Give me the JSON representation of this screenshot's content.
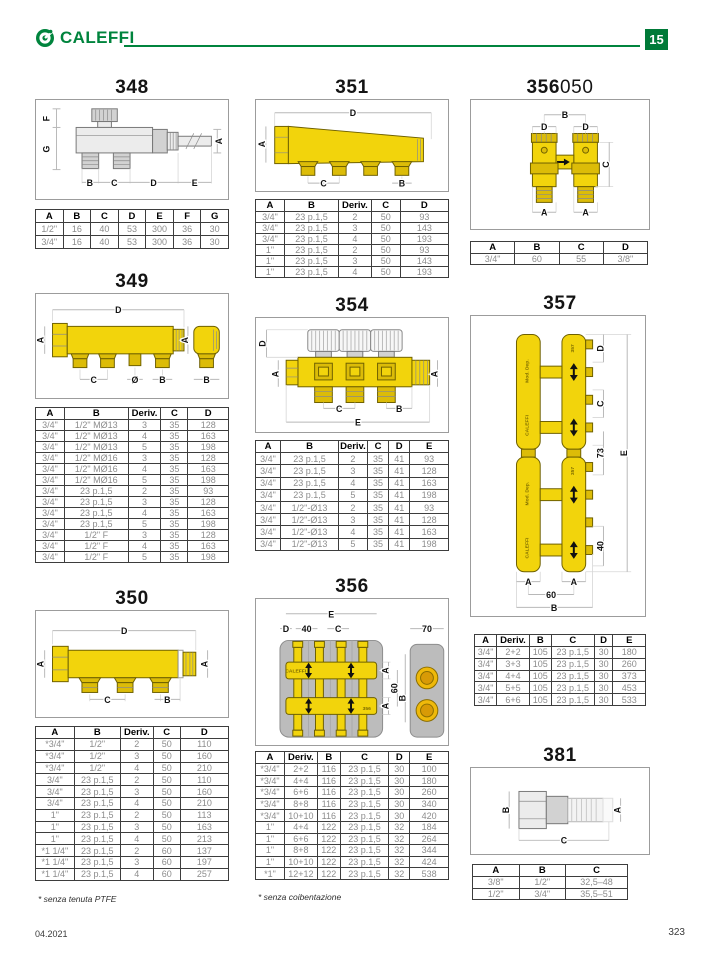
{
  "header": {
    "brand": "CALEFFI",
    "badge": "15"
  },
  "footer": {
    "date": "04.2021",
    "page": "323"
  },
  "s348": {
    "title": "348",
    "labels": {
      "a": "A",
      "b": "B",
      "c": "C",
      "d": "D",
      "e": "E",
      "f": "F",
      "g": "G"
    },
    "table": {
      "headers": [
        "A",
        "B",
        "C",
        "D",
        "E",
        "F",
        "G"
      ],
      "rows": [
        [
          "1/2\"",
          "16",
          "40",
          "53",
          "300",
          "36",
          "30"
        ],
        [
          "3/4\"",
          "16",
          "40",
          "53",
          "300",
          "36",
          "30"
        ]
      ]
    }
  },
  "s349": {
    "title": "349",
    "labels": {
      "d": "D",
      "a_left": "A",
      "a_right": "A",
      "c": "C",
      "diam": "Ø",
      "b": "B",
      "b_elbow": "B"
    },
    "table": {
      "headers": [
        "A",
        "B",
        "Deriv.",
        "C",
        "D"
      ],
      "rows": [
        [
          "3/4\"",
          "1/2\" MØ13",
          "3",
          "35",
          "128"
        ],
        [
          "3/4\"",
          "1/2\" MØ13",
          "4",
          "35",
          "163"
        ],
        [
          "3/4\"",
          "1/2\" MØ13",
          "5",
          "35",
          "198"
        ],
        [
          "3/4\"",
          "1/2\" MØ16",
          "3",
          "35",
          "128"
        ],
        [
          "3/4\"",
          "1/2\" MØ16",
          "4",
          "35",
          "163"
        ],
        [
          "3/4\"",
          "1/2\" MØ16",
          "5",
          "35",
          "198"
        ],
        [
          "3/4\"",
          "23 p.1,5",
          "2",
          "35",
          "93"
        ],
        [
          "3/4\"",
          "23 p.1,5",
          "3",
          "35",
          "128"
        ],
        [
          "3/4\"",
          "23 p.1,5",
          "4",
          "35",
          "163"
        ],
        [
          "3/4\"",
          "23 p.1,5",
          "5",
          "35",
          "198"
        ],
        [
          "3/4\"",
          "1/2\" F",
          "3",
          "35",
          "128"
        ],
        [
          "3/4\"",
          "1/2\" F",
          "4",
          "35",
          "163"
        ],
        [
          "3/4\"",
          "1/2\" F",
          "5",
          "35",
          "198"
        ]
      ]
    }
  },
  "s350": {
    "title": "350",
    "labels": {
      "d": "D",
      "a_left": "A",
      "a_right": "A",
      "c": "C",
      "b": "B"
    },
    "footnote": "* senza tenuta PTFE",
    "table": {
      "headers": [
        "A",
        "B",
        "Deriv.",
        "C",
        "D"
      ],
      "rows": [
        [
          "*3/4\"",
          "1/2\"",
          "2",
          "50",
          "110"
        ],
        [
          "*3/4\"",
          "1/2\"",
          "3",
          "50",
          "160"
        ],
        [
          "*3/4\"",
          "1/2\"",
          "4",
          "50",
          "210"
        ],
        [
          "3/4\"",
          "23 p.1,5",
          "2",
          "50",
          "110"
        ],
        [
          "3/4\"",
          "23 p.1,5",
          "3",
          "50",
          "160"
        ],
        [
          "3/4\"",
          "23 p.1,5",
          "4",
          "50",
          "210"
        ],
        [
          "1\"",
          "23 p.1,5",
          "2",
          "50",
          "113"
        ],
        [
          "1\"",
          "23 p.1,5",
          "3",
          "50",
          "163"
        ],
        [
          "1\"",
          "23 p.1,5",
          "4",
          "50",
          "213"
        ],
        [
          "*1 1/4\"",
          "23 p.1,5",
          "2",
          "60",
          "137"
        ],
        [
          "*1 1/4\"",
          "23 p.1,5",
          "3",
          "60",
          "197"
        ],
        [
          "*1 1/4\"",
          "23 p.1,5",
          "4",
          "60",
          "257"
        ]
      ]
    }
  },
  "s351": {
    "title": "351",
    "labels": {
      "d": "D",
      "a": "A",
      "c": "C",
      "b": "B"
    },
    "table": {
      "headers": [
        "A",
        "B",
        "Deriv.",
        "C",
        "D"
      ],
      "rows": [
        [
          "3/4\"",
          "23 p.1,5",
          "2",
          "50",
          "93"
        ],
        [
          "3/4\"",
          "23 p.1,5",
          "3",
          "50",
          "143"
        ],
        [
          "3/4\"",
          "23 p.1,5",
          "4",
          "50",
          "193"
        ],
        [
          "1\"",
          "23 p.1,5",
          "2",
          "50",
          "93"
        ],
        [
          "1\"",
          "23 p.1,5",
          "3",
          "50",
          "143"
        ],
        [
          "1\"",
          "23 p.1,5",
          "4",
          "50",
          "193"
        ]
      ]
    }
  },
  "s354": {
    "title": "354",
    "labels": {
      "d": "D",
      "a_left": "A",
      "a_right": "A",
      "c": "C",
      "b": "B",
      "e": "E"
    },
    "table": {
      "headers": [
        "A",
        "B",
        "Deriv.",
        "C",
        "D",
        "E"
      ],
      "rows": [
        [
          "3/4\"",
          "23 p.1,5",
          "2",
          "35",
          "41",
          "93"
        ],
        [
          "3/4\"",
          "23 p.1,5",
          "3",
          "35",
          "41",
          "128"
        ],
        [
          "3/4\"",
          "23 p.1,5",
          "4",
          "35",
          "41",
          "163"
        ],
        [
          "3/4\"",
          "23 p.1,5",
          "5",
          "35",
          "41",
          "198"
        ],
        [
          "3/4\"",
          "1/2\"-Ø13",
          "2",
          "35",
          "41",
          "93"
        ],
        [
          "3/4\"",
          "1/2\"-Ø13",
          "3",
          "35",
          "41",
          "128"
        ],
        [
          "3/4\"",
          "1/2\"-Ø13",
          "4",
          "35",
          "41",
          "163"
        ],
        [
          "3/4\"",
          "1/2\"-Ø13",
          "5",
          "35",
          "41",
          "198"
        ]
      ]
    }
  },
  "s356": {
    "title": "356",
    "labels": {
      "e": "E",
      "d": "D",
      "n40": "40",
      "c": "C",
      "n70": "70",
      "a_top": "A",
      "a_bot": "A",
      "n60": "60",
      "b": "B"
    },
    "diagram_text": {
      "brand": "CALEFFI",
      "model": "356"
    },
    "footnote": "* senza coibentazione",
    "table": {
      "headers": [
        "A",
        "Deriv.",
        "B",
        "C",
        "D",
        "E"
      ],
      "rows": [
        [
          "*3/4\"",
          "2+2",
          "116",
          "23 p.1,5",
          "30",
          "100"
        ],
        [
          "*3/4\"",
          "4+4",
          "116",
          "23 p.1,5",
          "30",
          "180"
        ],
        [
          "*3/4\"",
          "6+6",
          "116",
          "23 p.1,5",
          "30",
          "260"
        ],
        [
          "*3/4\"",
          "8+8",
          "116",
          "23 p.1,5",
          "30",
          "340"
        ],
        [
          "*3/4\"",
          "10+10",
          "116",
          "23 p.1,5",
          "30",
          "420"
        ],
        [
          "1\"",
          "4+4",
          "122",
          "23 p.1,5",
          "32",
          "184"
        ],
        [
          "1\"",
          "6+6",
          "122",
          "23 p.1,5",
          "32",
          "264"
        ],
        [
          "1\"",
          "8+8",
          "122",
          "23 p.1,5",
          "32",
          "344"
        ],
        [
          "1\"",
          "10+10",
          "122",
          "23 p.1,5",
          "32",
          "424"
        ],
        [
          "*1\"",
          "12+12",
          "122",
          "23 p.1,5",
          "32",
          "538"
        ]
      ]
    }
  },
  "s356050": {
    "title_bold": "356",
    "title_rest": "050",
    "labels": {
      "b": "B",
      "d_left": "D",
      "d_right": "D",
      "c": "C",
      "a_left": "A",
      "a_right": "A"
    },
    "table": {
      "headers": [
        "A",
        "B",
        "C",
        "D"
      ],
      "rows": [
        [
          "3/4\"",
          "60",
          "55",
          "3/8\""
        ]
      ]
    }
  },
  "s357": {
    "title": "357",
    "labels": {
      "d": "D",
      "c": "C",
      "n73": "73",
      "e": "E",
      "n40": "40",
      "a_left": "A",
      "a_right": "A",
      "n60": "60",
      "b": "B"
    },
    "diagram_text": {
      "brand": "CALEFFI",
      "dep": "Mod. Dep.",
      "model": "357"
    },
    "table": {
      "headers": [
        "A",
        "Deriv.",
        "B",
        "C",
        "D",
        "E"
      ],
      "rows": [
        [
          "3/4\"",
          "2+2",
          "105",
          "23 p.1,5",
          "30",
          "180"
        ],
        [
          "3/4\"",
          "3+3",
          "105",
          "23 p.1,5",
          "30",
          "260"
        ],
        [
          "3/4\"",
          "4+4",
          "105",
          "23 p.1,5",
          "30",
          "373"
        ],
        [
          "3/4\"",
          "5+5",
          "105",
          "23 p.1,5",
          "30",
          "453"
        ],
        [
          "3/4\"",
          "6+6",
          "105",
          "23 p.1,5",
          "30",
          "533"
        ]
      ]
    }
  },
  "s381": {
    "title": "381",
    "labels": {
      "b": "B",
      "a": "A",
      "c": "C"
    },
    "table": {
      "headers": [
        "A",
        "B",
        "C"
      ],
      "rows": [
        [
          "3/8\"",
          "1/2\"",
          "32,5–48"
        ],
        [
          "1/2\"",
          "3/4\"",
          "35,5–51"
        ]
      ]
    }
  }
}
